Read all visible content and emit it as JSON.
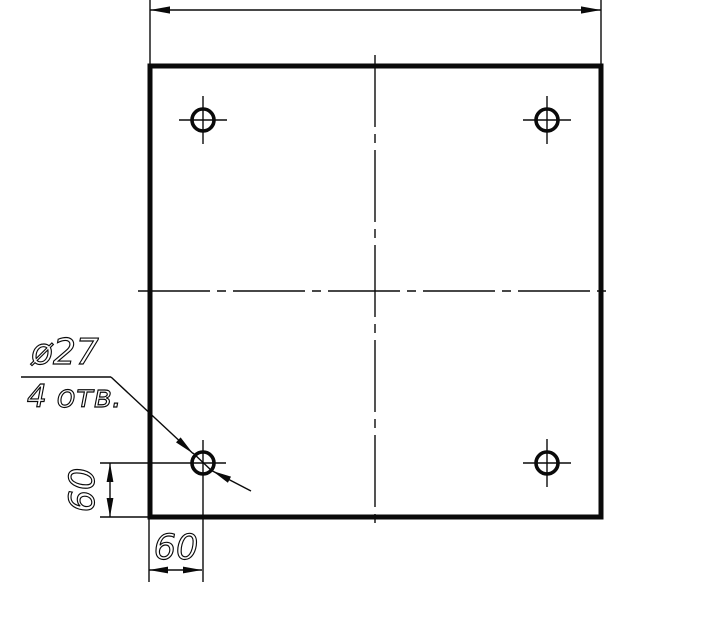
{
  "drawing": {
    "kind": "engineering-drawing",
    "subject": "square plate with four drilled holes",
    "background_color": "#ffffff",
    "line_color": "#0a0a0a",
    "leader": {
      "diameter_label": "ø27",
      "count_label": "4 отв."
    },
    "dimensions": {
      "left_vertical": "60",
      "bottom_horizontal": "60"
    },
    "holes": {
      "count": 4,
      "diameter_mm": 27,
      "corner_offset_x_mm": 60,
      "corner_offset_y_mm": 60
    }
  }
}
